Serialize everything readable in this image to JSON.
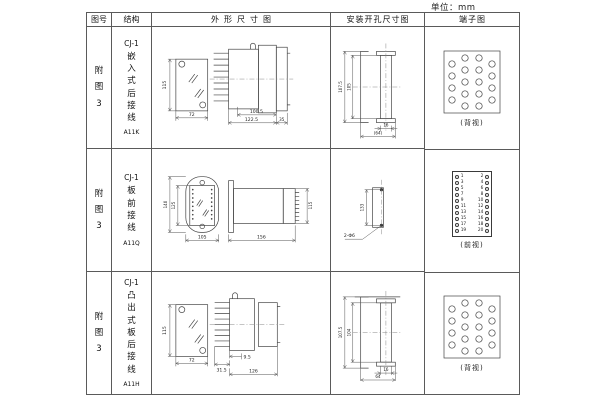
{
  "page": {
    "unit_label": "单位：mm"
  },
  "table": {
    "headers": {
      "fig_no": "图号",
      "structure": "结构",
      "outline": "外形尺寸图",
      "mounting": "安装开孔尺寸图",
      "terminal": "端子图"
    }
  },
  "rows": [
    {
      "fig_no": "附图3",
      "model": "CJ-1",
      "mount_type": "嵌入式后接线",
      "code": "A11K",
      "outline": {
        "front_h": "115",
        "front_w": "72",
        "body_l": "100.5",
        "total_l": "122.5",
        "flange_d": "35"
      },
      "mounting": {
        "h_outer": "107.5",
        "h_inner": "105",
        "w_slot": "16",
        "w_overall": "(64)"
      },
      "terminal_caption": "(背视)"
    },
    {
      "fig_no": "附图3",
      "model": "CJ-1",
      "mount_type": "板前接线",
      "code": "A11Q",
      "outline": {
        "front_h_outer": "140",
        "front_h_inner": "125",
        "front_w": "105",
        "side_l": "156",
        "side_h": "115"
      },
      "mounting": {
        "hole_spacing": "133",
        "holes": "2-Φ6"
      },
      "terminal_caption": "(前视)"
    },
    {
      "fig_no": "附图3",
      "model": "CJ-1",
      "mount_type": "凸出式板后接线",
      "code": "A11H",
      "outline": {
        "front_h": "115",
        "front_w": "72",
        "pin_l": "31.5",
        "gap": "9.5",
        "body_l": "126"
      },
      "mounting": {
        "h_outer": "107.5",
        "h_inner": "104",
        "w_slot": "16",
        "w_overall": "64"
      },
      "terminal_caption": "(背视)"
    }
  ],
  "front_terminal": {
    "pairs": [
      {
        "l": "1",
        "r": "2"
      },
      {
        "l": "3",
        "r": "4"
      },
      {
        "l": "5",
        "r": "6"
      },
      {
        "l": "7",
        "r": "8"
      },
      {
        "l": "9",
        "r": "10"
      },
      {
        "l": "11",
        "r": "12"
      },
      {
        "l": "13",
        "r": "14"
      },
      {
        "l": "15",
        "r": "16"
      },
      {
        "l": "17",
        "r": "18"
      },
      {
        "l": "19",
        "r": "20"
      }
    ]
  },
  "colors": {
    "line": "#444444",
    "text": "#222222",
    "border": "#5a5a5a",
    "background": "#ffffff"
  }
}
